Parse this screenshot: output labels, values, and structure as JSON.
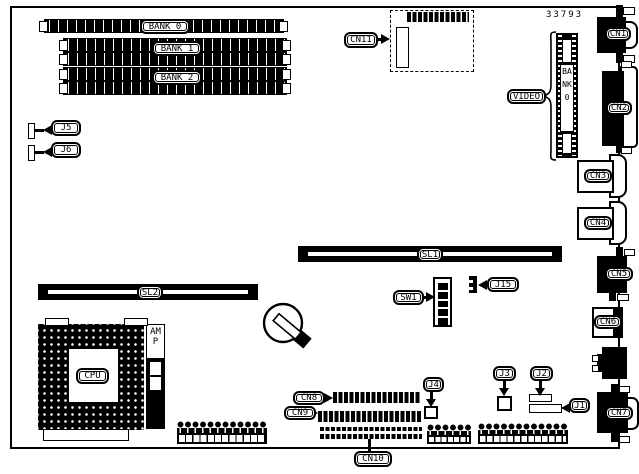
{
  "figure": {
    "part_number": "33793",
    "memory": {
      "bank0_label": "BANK 0",
      "bank1_label": "BANK 1",
      "bank2_label": "BANK 2"
    },
    "video_memory": {
      "callout": "VIDEO",
      "bank_label": "BANK0"
    },
    "expansion_slots": {
      "sl1": "SL1",
      "sl2": "SL2"
    },
    "processor": {
      "cpu_label": "CPU",
      "amp_label": "AMP"
    },
    "connectors": {
      "cn1": "CN1",
      "cn2": "CN2",
      "cn3": "CN3",
      "cn4": "CN4",
      "cn5": "CN5",
      "cn6": "CN6",
      "cn7": "CN7",
      "cn8": "CN8",
      "cn9": "CN9",
      "cn10": "CN10",
      "cn11": "CN11"
    },
    "jumpers": {
      "j1": "J1",
      "j2": "J2",
      "j3": "J3",
      "j4": "J4",
      "j5": "J5",
      "j6": "J6",
      "j15": "J15"
    },
    "switches": {
      "sw1": "SW1"
    },
    "colors": {
      "ink": "#000000",
      "paper": "#ffffff"
    }
  }
}
